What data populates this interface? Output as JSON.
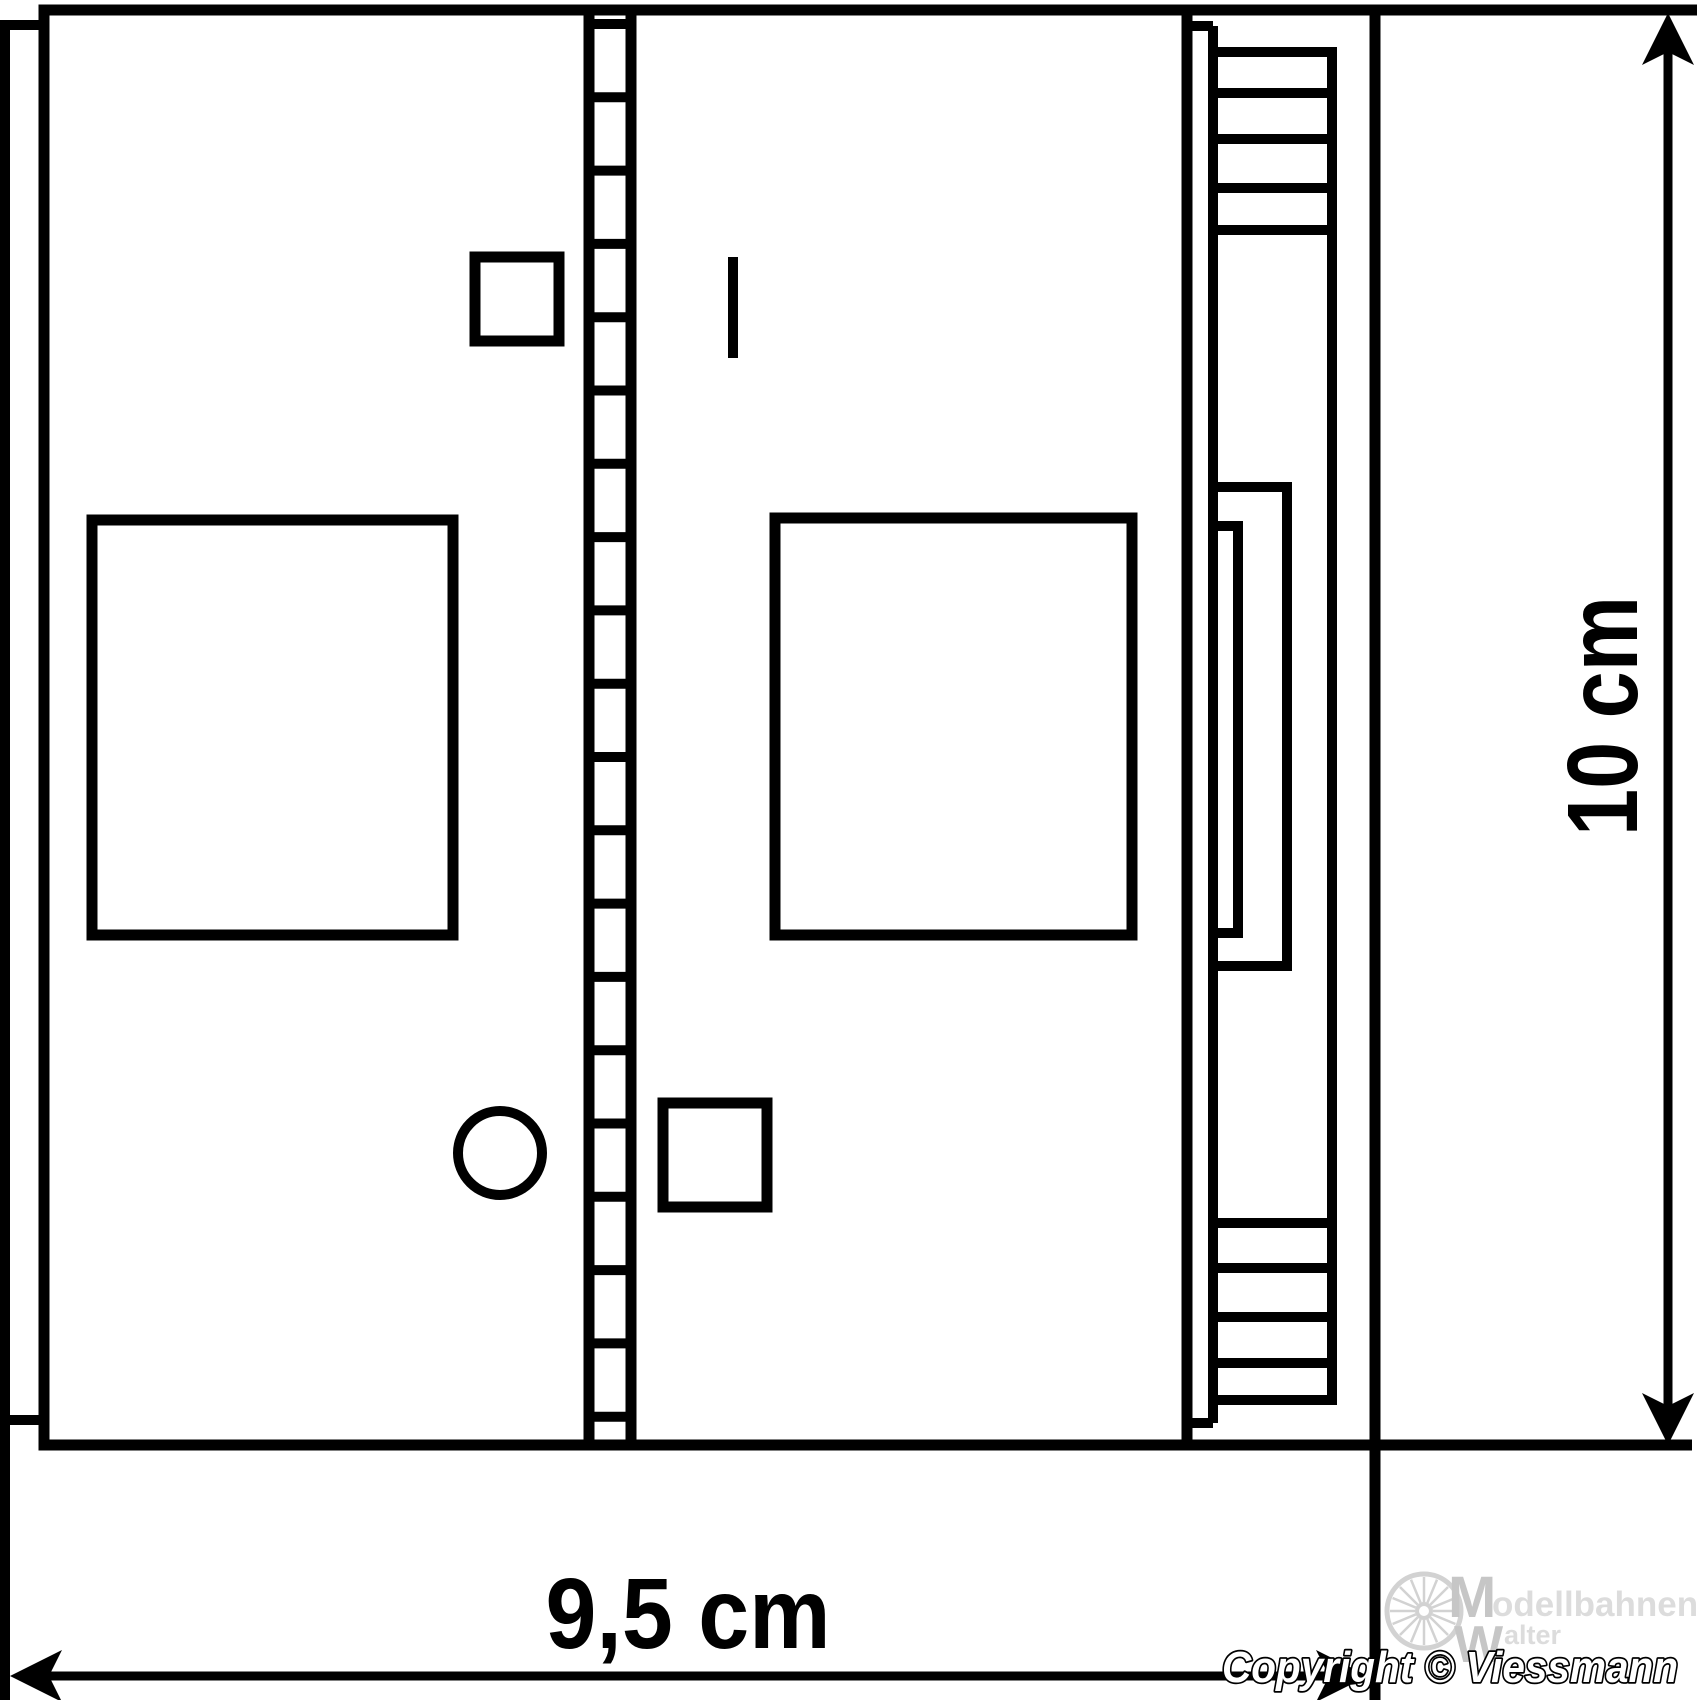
{
  "dimensions": {
    "width": {
      "label": "9,5 cm"
    },
    "height": {
      "label": "10 cm"
    }
  },
  "branding": {
    "copyright": "Copyright © Viessmann",
    "watermark": {
      "top_initial": "M",
      "top_rest": "odellbahnen",
      "bottom_initial": "W",
      "bottom_rest": "alter"
    }
  },
  "figure": {
    "ladder_rung_count": 20,
    "cooling_fin_rows_top": 5,
    "cooling_fin_rows_bottom": 5,
    "wheel_spoke_count": 16
  },
  "colors": {
    "line": "#000000",
    "background": "#ffffff",
    "watermark_light": "#dcdcdc",
    "watermark_mid": "#c6c6c6"
  }
}
